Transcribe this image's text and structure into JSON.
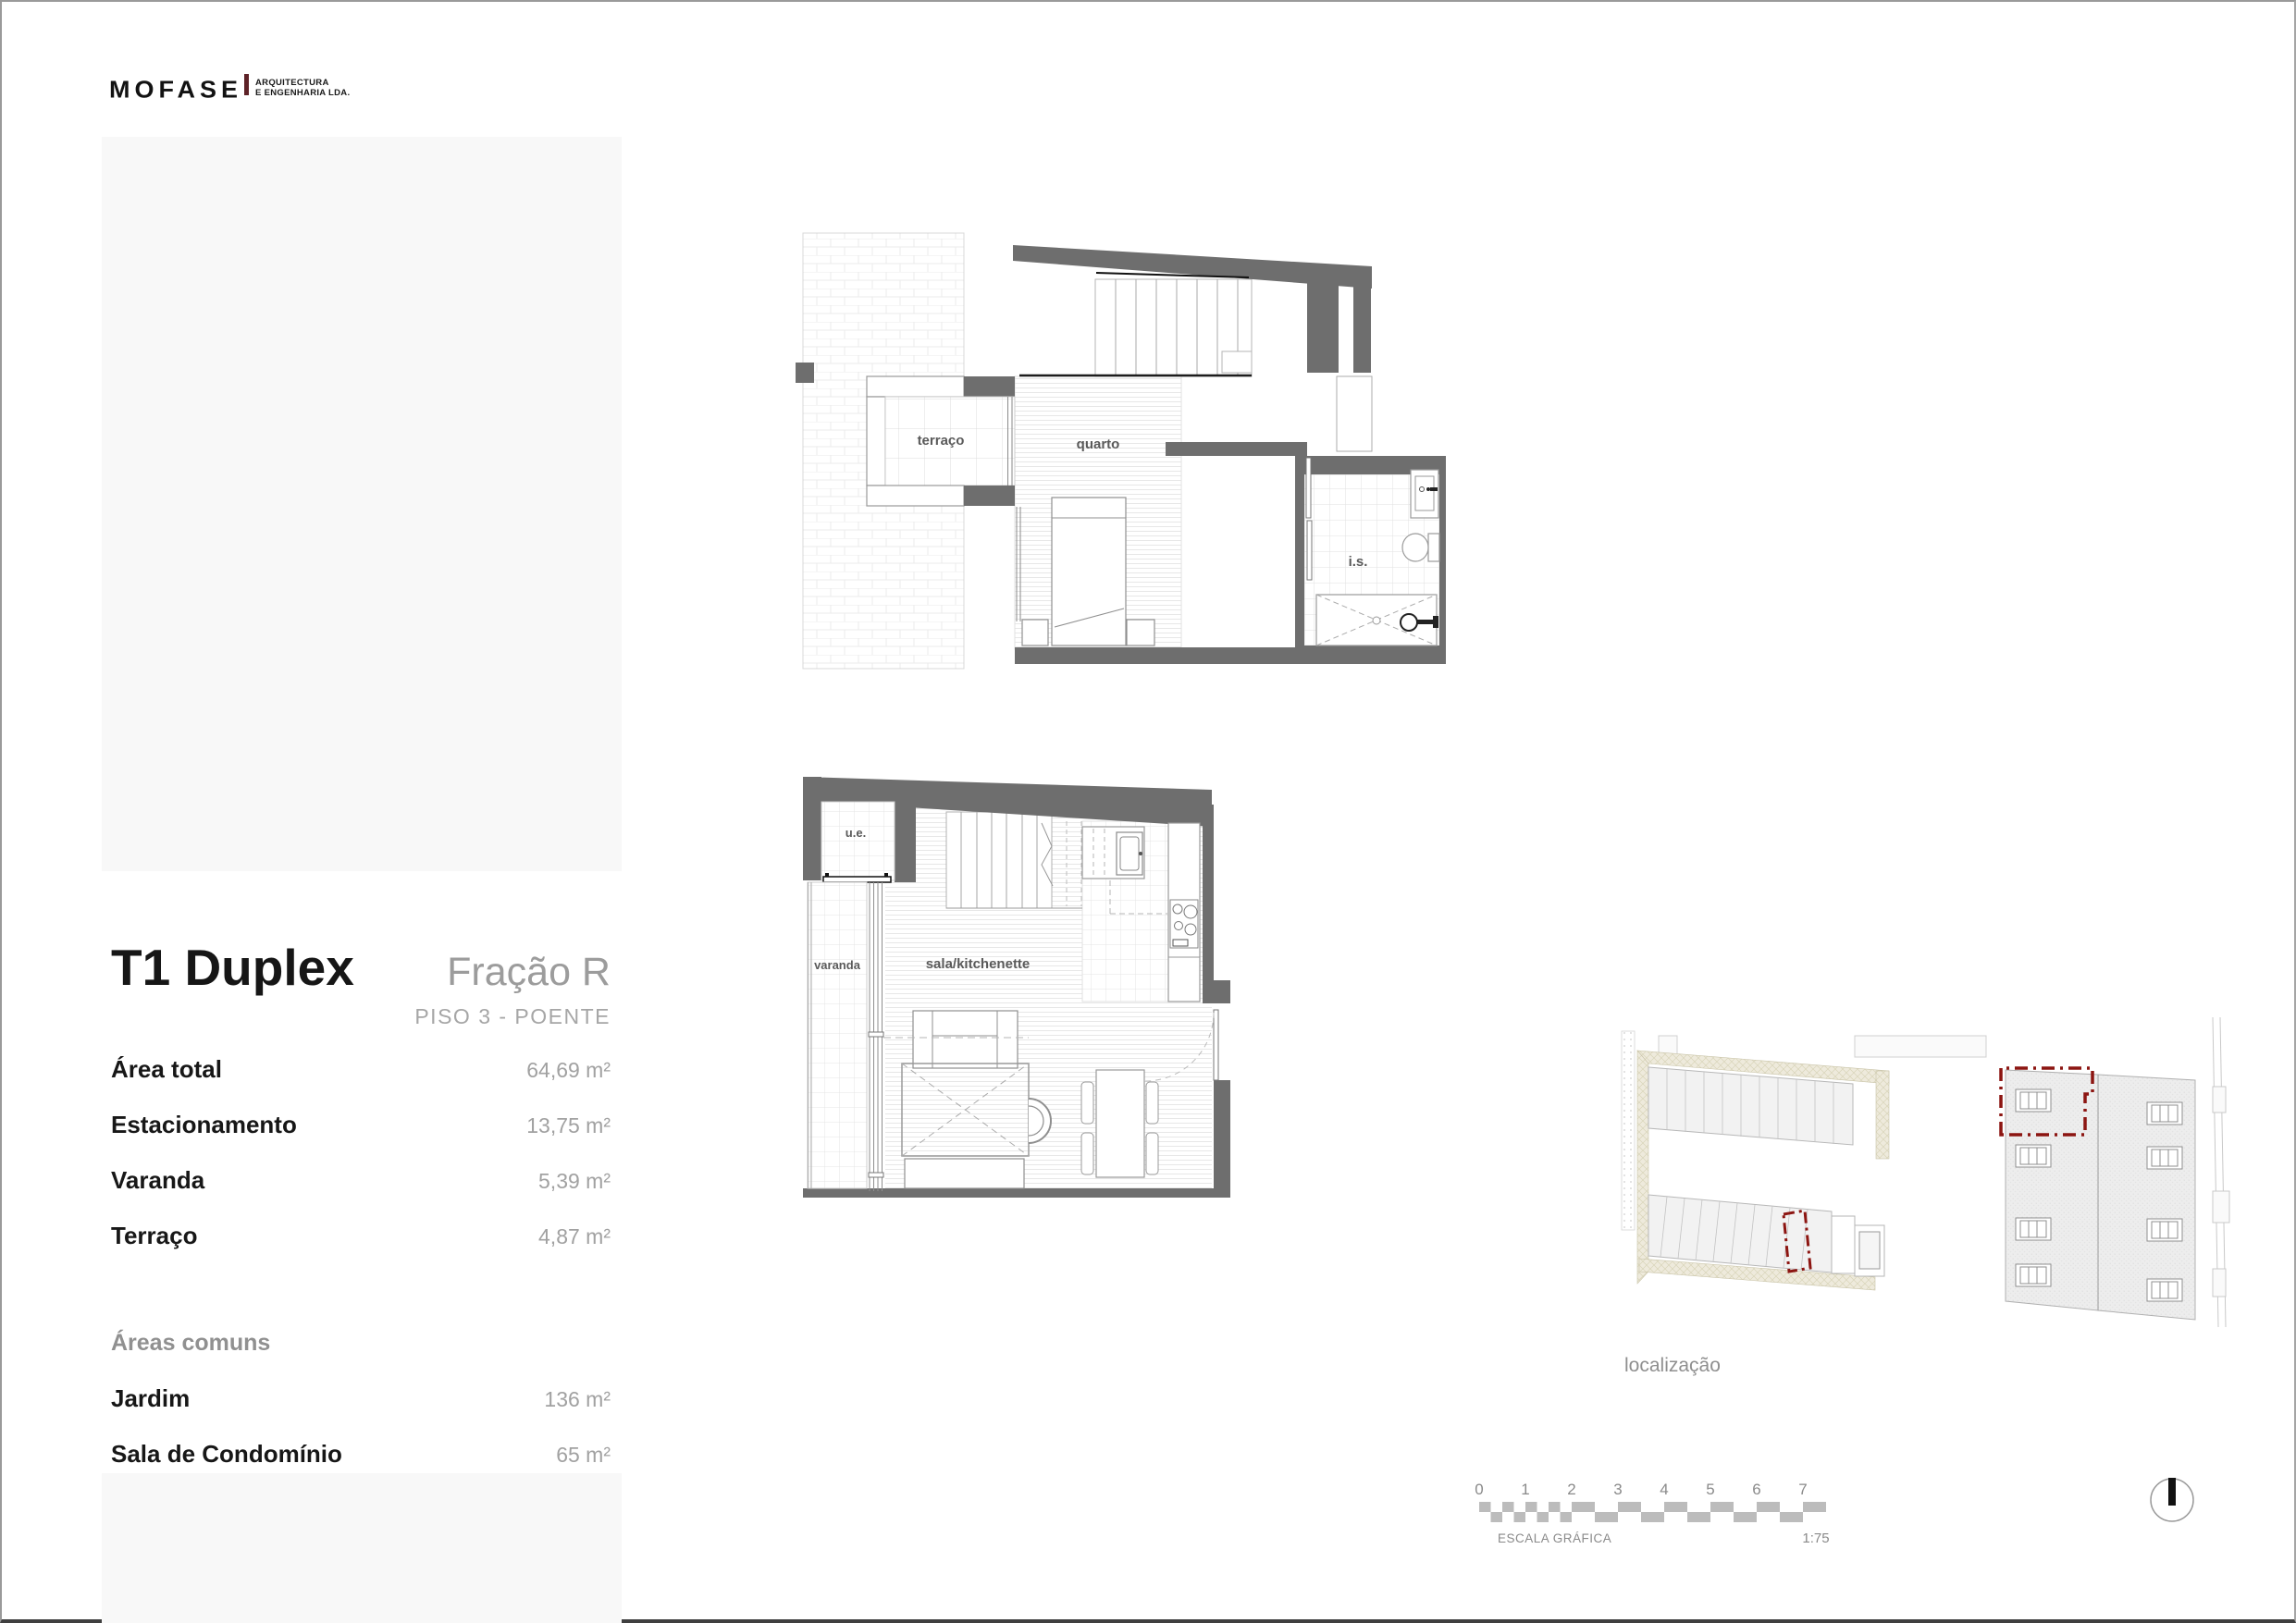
{
  "logo": {
    "brand": "MOFASE",
    "tagline_line1": "ARQUITECTURA",
    "tagline_line2": "E ENGENHARIA LDA."
  },
  "unit": {
    "title": "T1 Duplex",
    "fraction": "Fração R",
    "floor": "PISO 3 - POENTE",
    "areas": [
      {
        "label": "Área total",
        "value": "64,69 m²"
      },
      {
        "label": "Estacionamento",
        "value": "13,75 m²"
      },
      {
        "label": "Varanda",
        "value": "5,39 m²"
      },
      {
        "label": "Terraço",
        "value": "4,87 m²"
      }
    ],
    "common_areas_title": "Áreas comuns",
    "common_areas": [
      {
        "label": "Jardim",
        "value": "136 m²"
      },
      {
        "label": "Sala de Condomínio",
        "value": "65 m²"
      }
    ]
  },
  "plans": {
    "upper": {
      "room_labels": [
        "terraço",
        "quarto",
        "i.s."
      ]
    },
    "lower": {
      "room_labels": [
        "u.e.",
        "varanda",
        "sala/kitchenette"
      ]
    }
  },
  "location": {
    "label": "localização"
  },
  "scale_bar": {
    "ticks": [
      "0",
      "1",
      "2",
      "3",
      "4",
      "5",
      "6",
      "7"
    ],
    "label": "ESCALA GRÁFICA",
    "ratio": "1:75"
  },
  "colors": {
    "wall_gray": "#6e6e6e",
    "accent_red": "#8c1511",
    "logo_red": "#5e2227",
    "panel_gray": "#f8f8f8"
  }
}
